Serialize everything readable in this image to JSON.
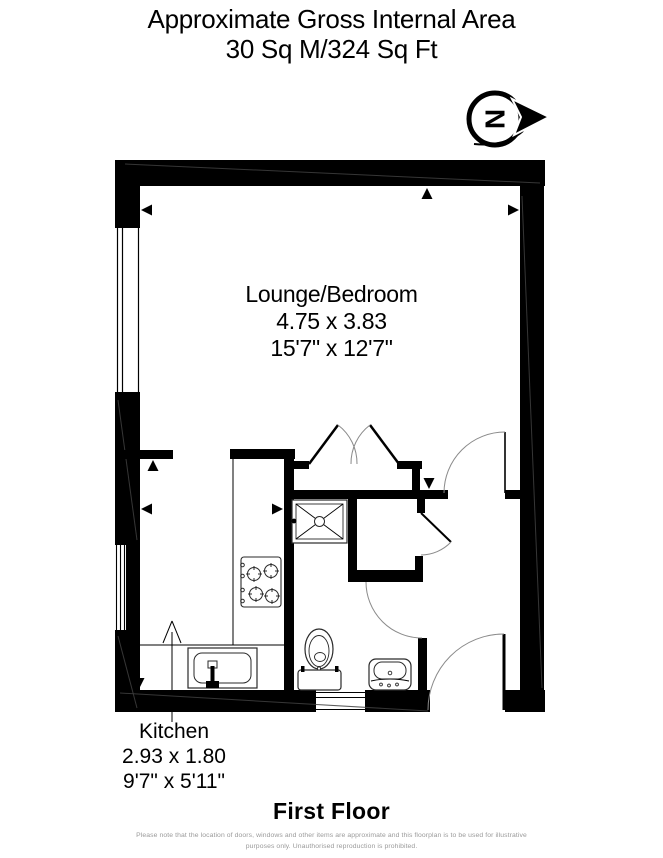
{
  "header": {
    "title_line1": "Approximate Gross Internal Area",
    "title_line2": "30 Sq M/324 Sq Ft"
  },
  "compass": {
    "letter": "N"
  },
  "rooms": {
    "lounge": {
      "name": "Lounge/Bedroom",
      "metric": "4.75 x 3.83",
      "imperial": "15'7\" x 12'7\""
    },
    "kitchen": {
      "name": "Kitchen",
      "metric": "2.93 x 1.80",
      "imperial": "9'7\" x 5'11\""
    }
  },
  "footer": {
    "floor_label": "First Floor",
    "disclaimer_line1": "Please note that the location of doors, windows and other items are approximate and this floorplan is to be used for illustrative",
    "disclaimer_line2": "purposes only. Unauthorised reproduction is prohibited."
  },
  "colors": {
    "wall": "#000000",
    "background": "#ffffff",
    "disclaimer_text": "#9a9a9a"
  }
}
